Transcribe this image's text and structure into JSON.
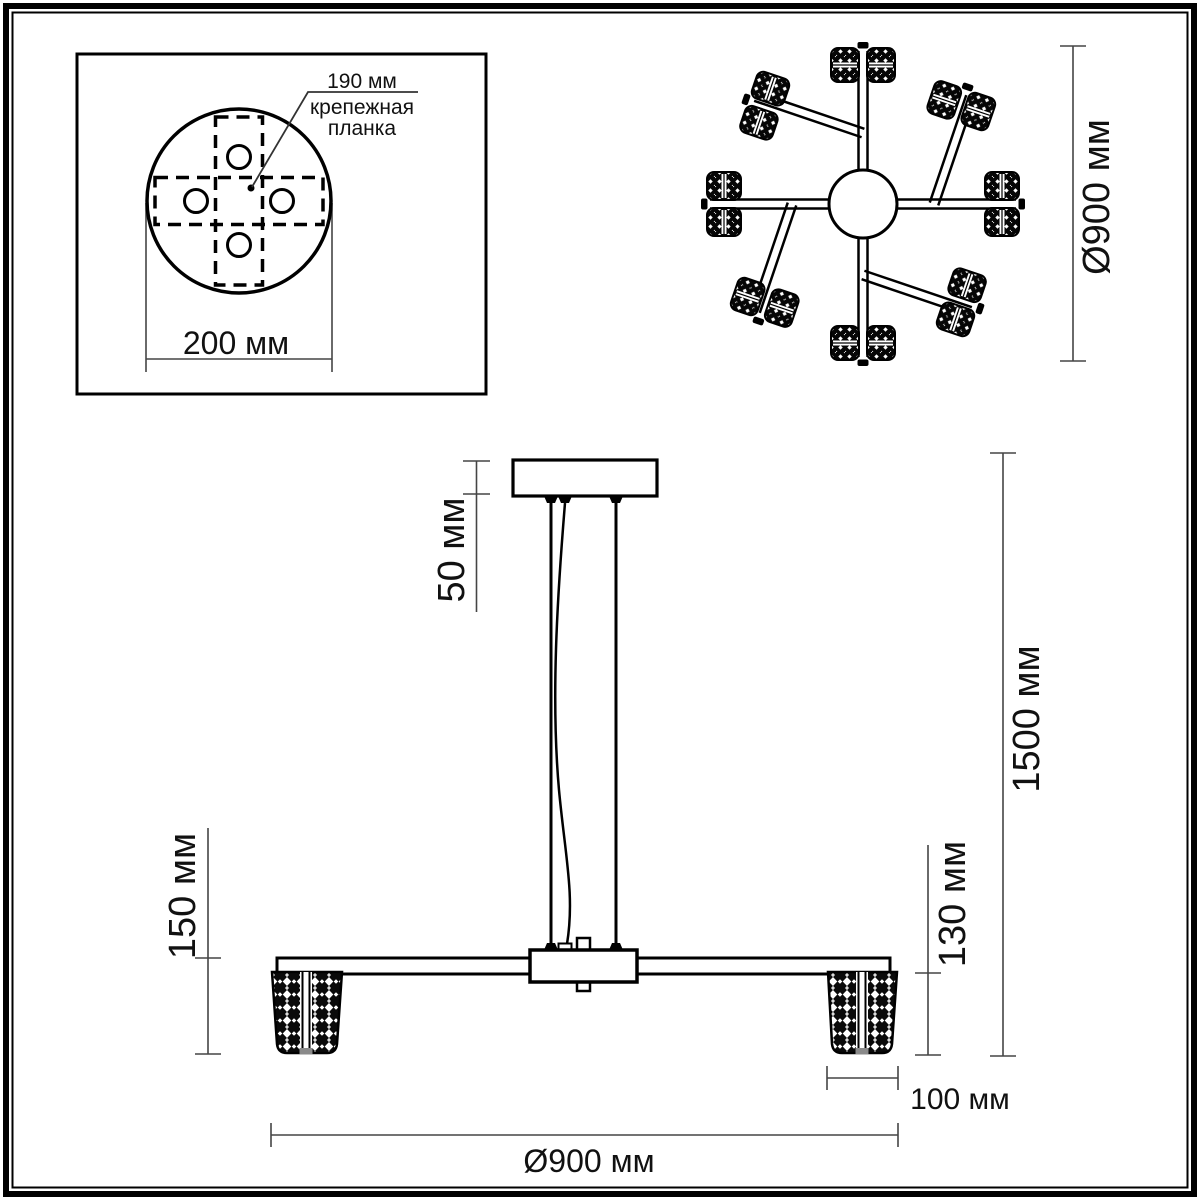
{
  "drawing_title": "chandelier-dimension-drawing",
  "colors": {
    "background": "#ffffff",
    "line": "#000000",
    "dim_line": "#454545",
    "text": "#111111"
  },
  "mounting_plate_inset": {
    "dim_bracket_length": "190 мм",
    "bracket_label_line1": "крепежная",
    "bracket_label_line2": "планка",
    "dim_plate_diameter": "200 мм"
  },
  "top_view": {
    "dim_fixture_diameter": "Ø900 мм",
    "arm_count": 8,
    "shade_count": 16
  },
  "side_view": {
    "dim_canopy_height": "50 мм",
    "dim_left_drop": "150 мм",
    "dim_shade_height": "130 мм",
    "dim_total_height": "1500 мм",
    "dim_shade_width": "100 мм",
    "dim_fixture_diameter": "Ø900 мм"
  }
}
